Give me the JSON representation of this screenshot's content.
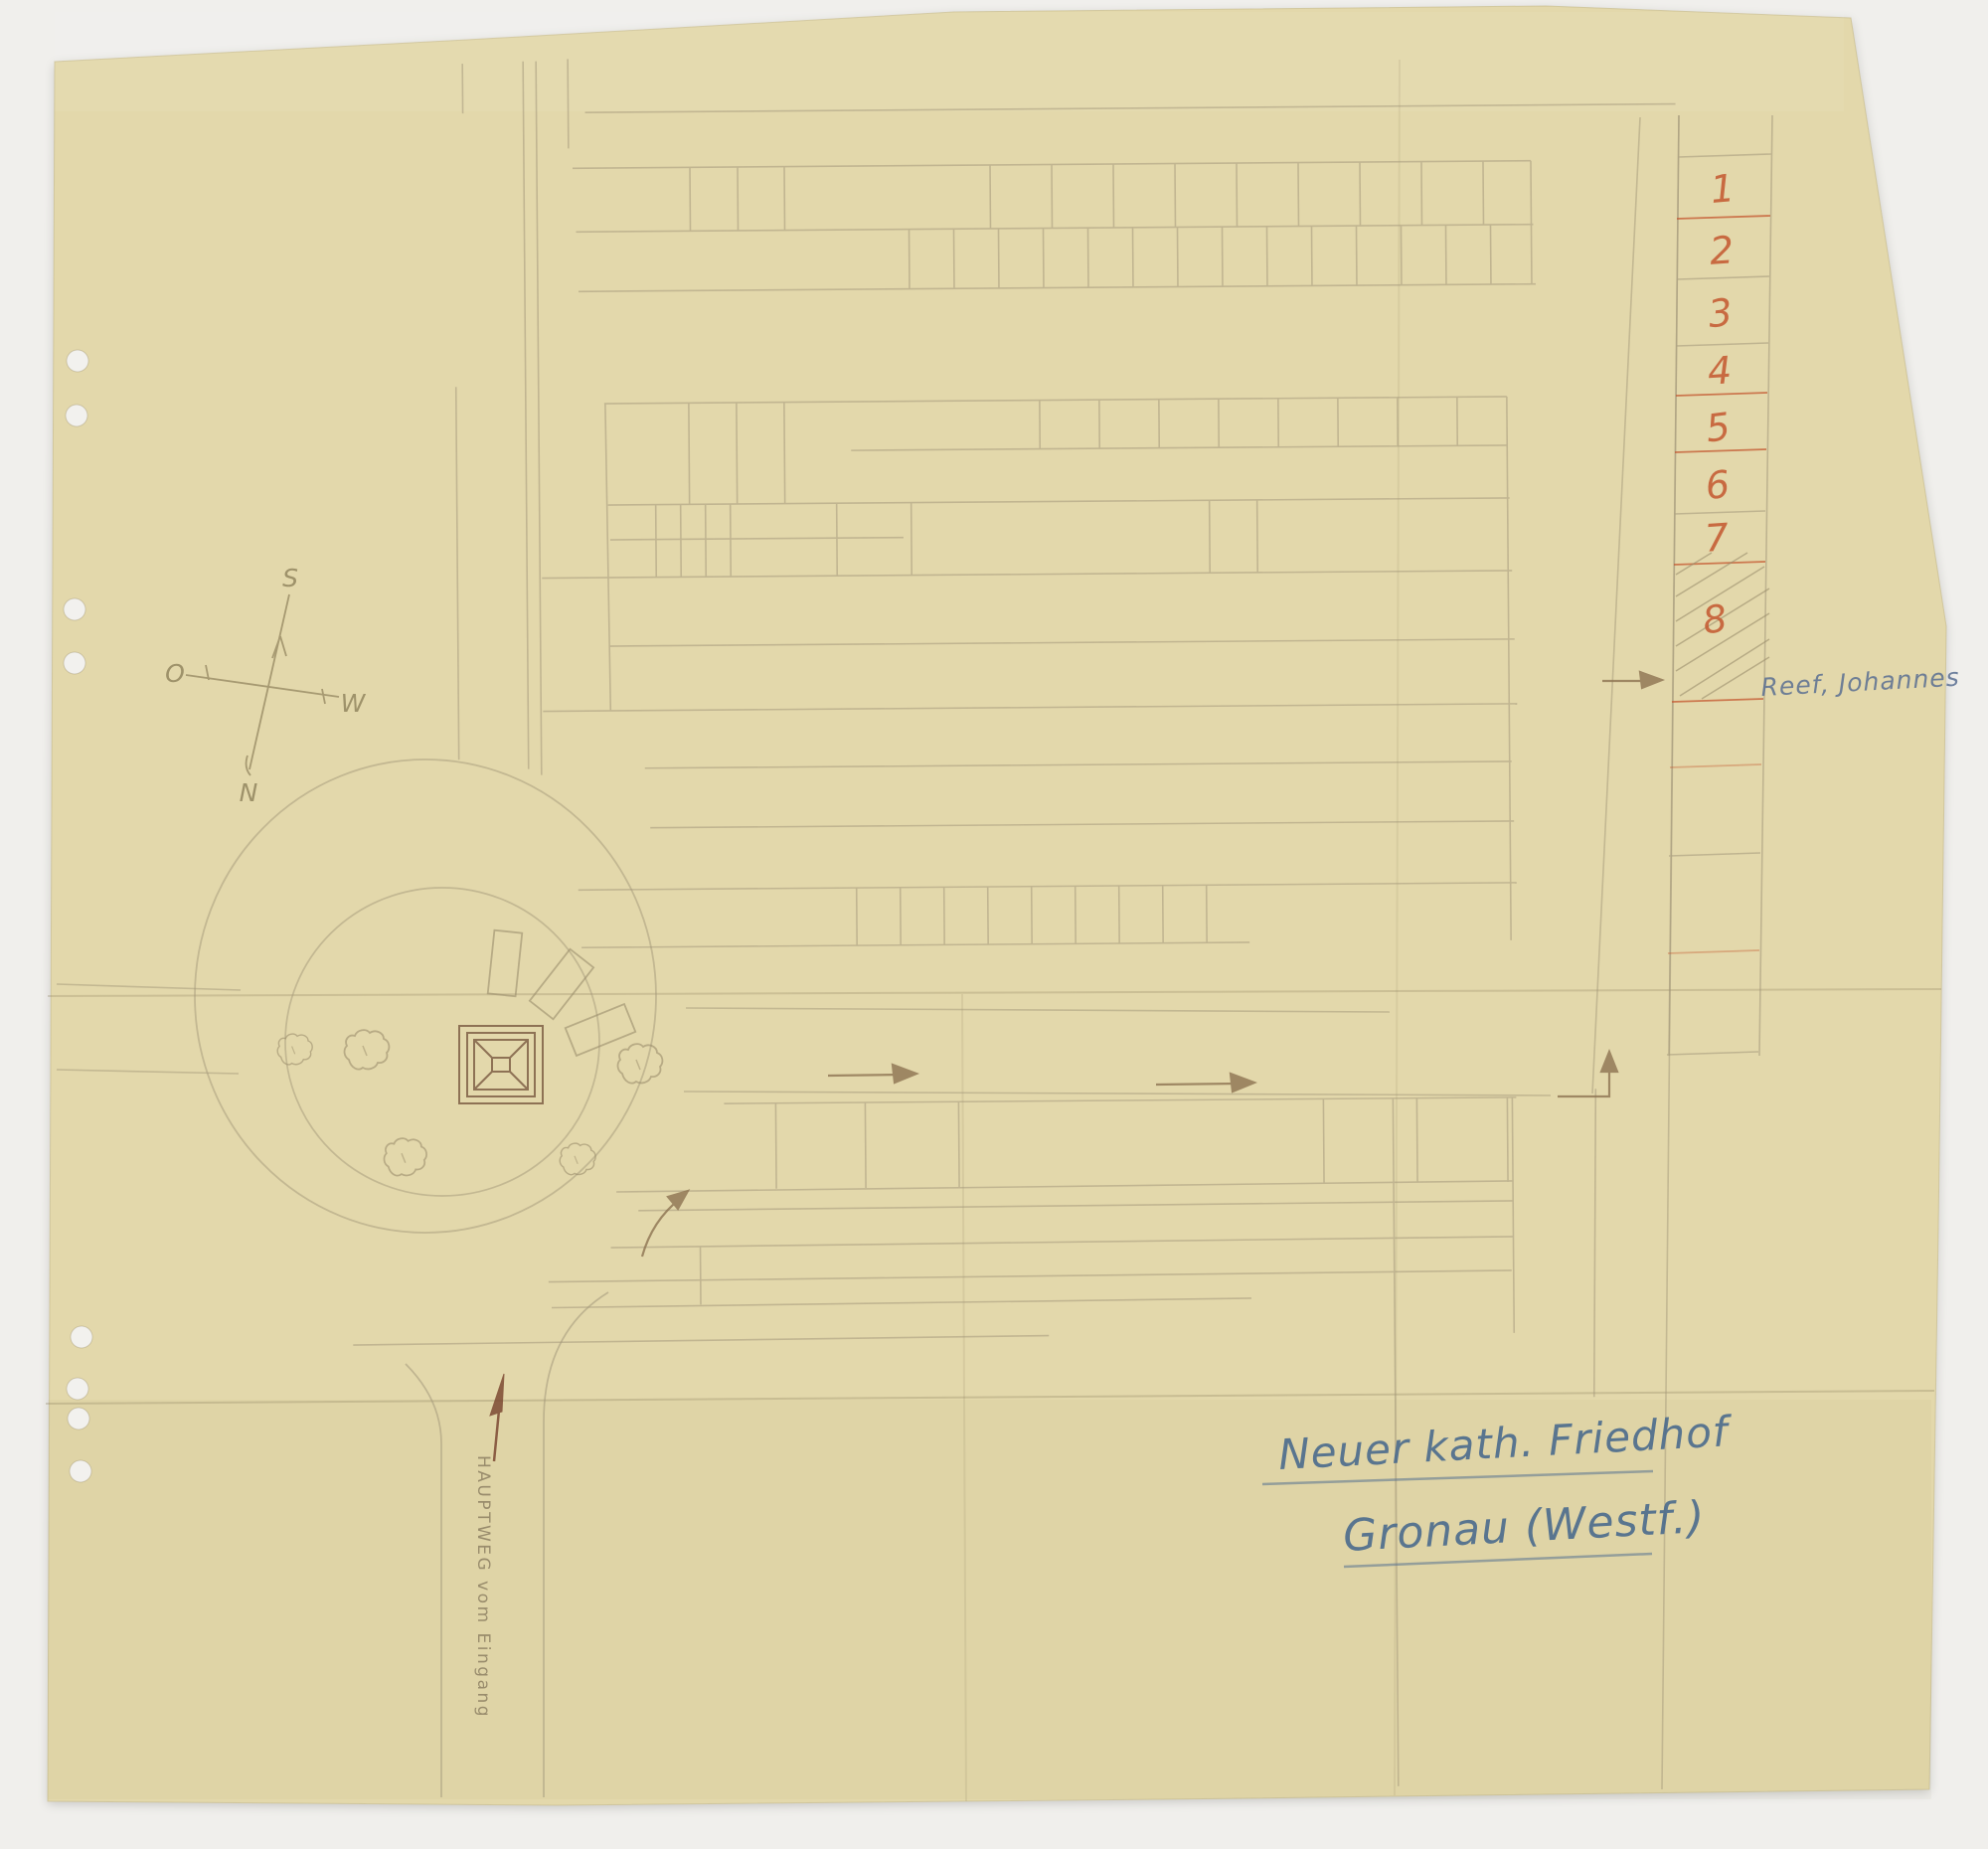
{
  "scan": {
    "background_color": "#f0efec",
    "paper_color": "#e3d8ab",
    "pencil_color": "#9b8e6c",
    "red_ink_color": "#c4572f",
    "blue_ink_color": "#47688c",
    "brown_ink_color": "#7d4a33"
  },
  "compass": {
    "south": "S",
    "east": "O",
    "west": "W",
    "north": "N"
  },
  "plot_register": {
    "cells": [
      {
        "number": "1"
      },
      {
        "number": "2"
      },
      {
        "number": "3"
      },
      {
        "number": "4"
      },
      {
        "number": "5"
      },
      {
        "number": "6"
      },
      {
        "number": "7"
      },
      {
        "number": "8"
      }
    ],
    "hatched_cell_note": "Reef, Johannes"
  },
  "entrance": {
    "path_label": "HAUPTWEG vom Eingang"
  },
  "title": {
    "line1": "Neuer kath. Friedhof",
    "line2": "Gronau (Westf.)"
  }
}
